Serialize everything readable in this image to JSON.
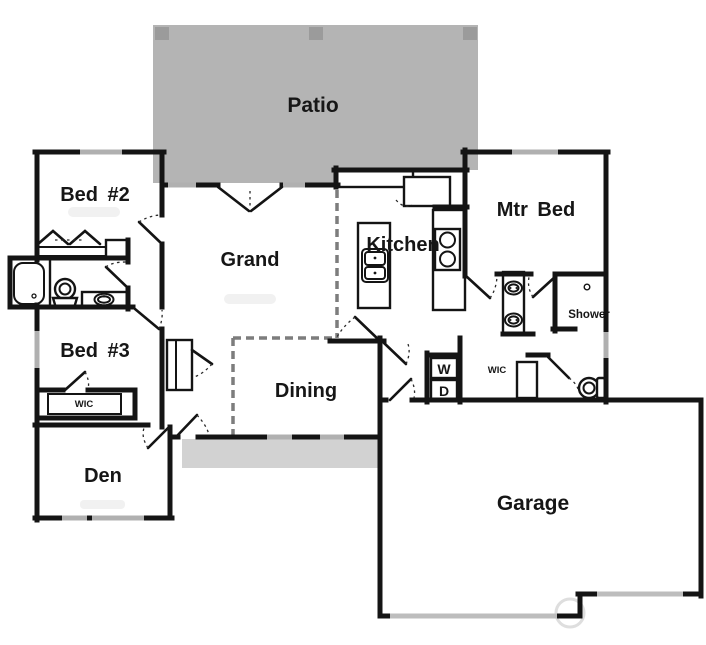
{
  "rooms": {
    "patio": {
      "label": "Patio"
    },
    "bed2": {
      "label": "Bed #2"
    },
    "grand": {
      "label": "Grand"
    },
    "kitchen": {
      "label": "Kitchen"
    },
    "mtr_bed": {
      "label": "Mtr Bed"
    },
    "bed3": {
      "label": "Bed #3"
    },
    "dining": {
      "label": "Dining"
    },
    "den": {
      "label": "Den"
    },
    "garage": {
      "label": "Garage"
    },
    "shower": {
      "label": "Shower"
    },
    "wic_bed3": {
      "label": "WIC"
    },
    "wic_master": {
      "label": "WIC"
    },
    "washer": {
      "label": "W"
    },
    "dryer": {
      "label": "D"
    }
  },
  "colors": {
    "patio_fill": "#b4b4b4",
    "patio_post": "#9b9b9b",
    "porch_fill": "#d2d2d2",
    "window_fill": "#b0b0b0",
    "garage_door_fill": "#bdbdbd",
    "wall": "#141414",
    "open_boundary_dash": "#7d7d7d"
  }
}
